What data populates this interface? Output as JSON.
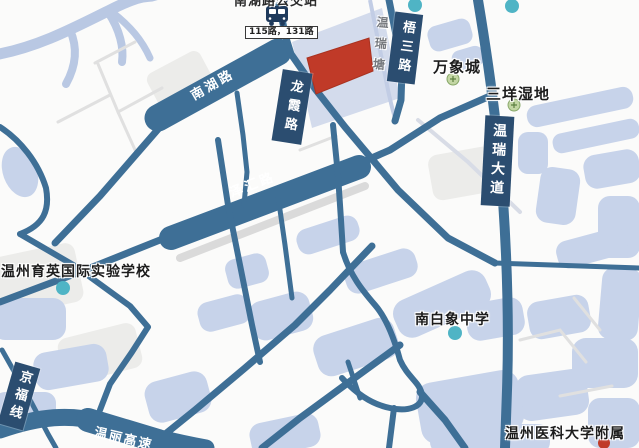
{
  "map": {
    "bus_stop": {
      "name_clipped": "南湖路公交站",
      "routes": "115路，131路"
    },
    "roads": {
      "nanhu": "南湖路",
      "longxia": "龙霞路",
      "wusan": "梧三路",
      "zehui": "泽汇路",
      "wenrui_avenue": "温瑞大道",
      "jingfu_line": "京福线",
      "wenli_expressway": "温丽高速"
    },
    "waterway": {
      "wenruitang": "温瑞塘"
    },
    "pois": [
      {
        "label": "万象城",
        "dot": "green"
      },
      {
        "label": "三垟湿地",
        "dot": "green"
      },
      {
        "label": "温州育英国际实验学校",
        "dot": "teal"
      },
      {
        "label": "南白象中学",
        "dot": "teal"
      },
      {
        "label": "温州医科大学附属",
        "dot": "red"
      }
    ],
    "highlight": {
      "parcel": "红色地块"
    },
    "colors": {
      "road": "#3e6f96",
      "label_box": "#2b4d70",
      "parcel_red": "#c03a28",
      "water_block": "#c7d3ea",
      "canal": "#b9c8e3",
      "poi_teal": "#4fb4c5",
      "poi_green_fill": "#c3d6a4",
      "poi_green_edge": "#87a768",
      "poi_red": "#c03a28",
      "minor_street": "#e0e0e0"
    }
  }
}
